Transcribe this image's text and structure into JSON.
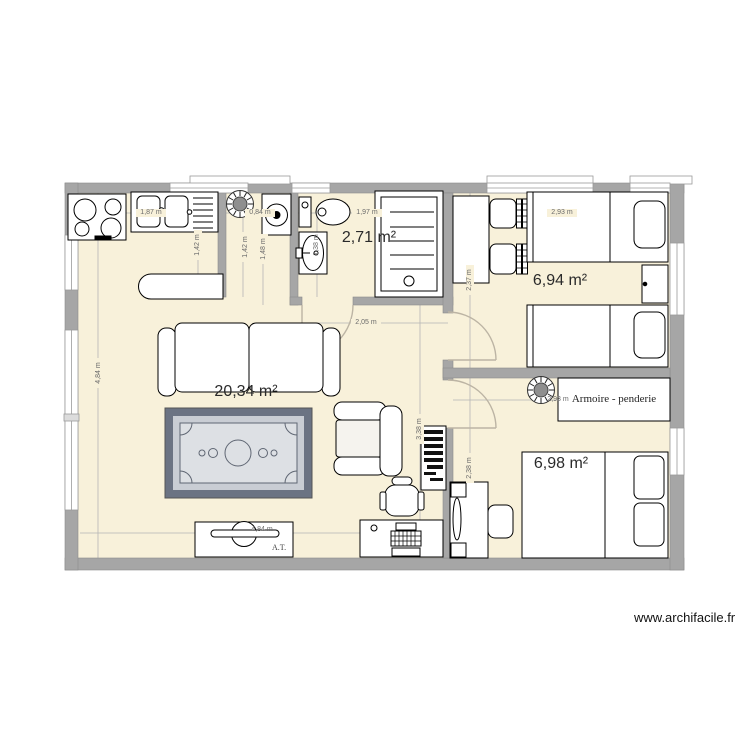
{
  "watermark": "www.archifacile.fr",
  "rooms": {
    "living": {
      "area": "20,34 m²"
    },
    "bathroom": {
      "area": "2,71 m²"
    },
    "bedroom1": {
      "area": "6,94 m²"
    },
    "bedroom2": {
      "area": "6,98 m²"
    }
  },
  "labels": {
    "wardrobe": "Armoire - penderie",
    "tv_unit": "A.T."
  },
  "dimensions": {
    "kitchen_width": "1,87 m",
    "laundry_width": "0,84 m",
    "bathroom_width": "1,97 m",
    "bedroom1_width": "2,93 m",
    "bedroom2_width": "2,93 m",
    "kitchen_depth": "1,42 m",
    "entry_depth": "1,42 m",
    "entry_depth_outer": "1,48 m",
    "bathroom_depth": "1,38 m",
    "hall_width": "2,05 m",
    "bedroom1_depth": "2,37 m",
    "bedroom2_depth": "2,38 m",
    "living_lower_depth": "3,38 m",
    "living_depth": "4,84 m",
    "living_width": "4,84 m"
  },
  "colors": {
    "floor": "#f8f1da",
    "wall": "#a6a6a6",
    "pool_table_frame": "#6b7383",
    "pool_table_surface": "#dde0e4",
    "door_arc": "#bcb4a4",
    "dimension_line": "#b5b5b5"
  }
}
